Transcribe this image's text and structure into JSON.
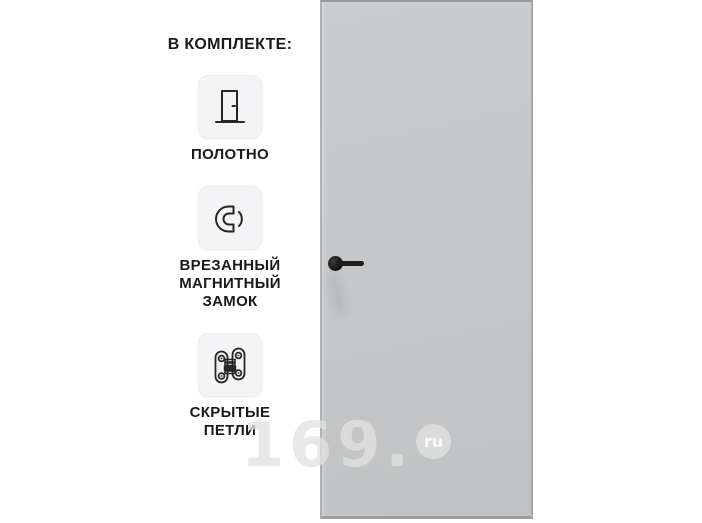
{
  "canvas": {
    "width": 702,
    "height": 523,
    "background": "#ffffff"
  },
  "included_panel": {
    "title": "В КОМПЛЕКТЕ:",
    "items": [
      {
        "name": "door-leaf",
        "icon": "door-icon",
        "label": "ПОЛОТНО"
      },
      {
        "name": "magnetic-lock",
        "icon": "magnet-icon",
        "label": "ВРЕЗАННЫЙ\nМАГНИТНЫЙ\nЗАМОК"
      },
      {
        "name": "hidden-hinges",
        "icon": "hinge-icon",
        "label": "СКРЫТЫЕ\nПЕТЛИ"
      }
    ]
  },
  "product": {
    "name": "gray-door-leaf-with-black-handle",
    "door_color": "#c5c7c9",
    "door_edge_color": "#a9abad",
    "handle_color": "#1d1d1d"
  },
  "watermark": {
    "text": "169.",
    "badge_text": "ru",
    "color": "#e2e2e2"
  }
}
